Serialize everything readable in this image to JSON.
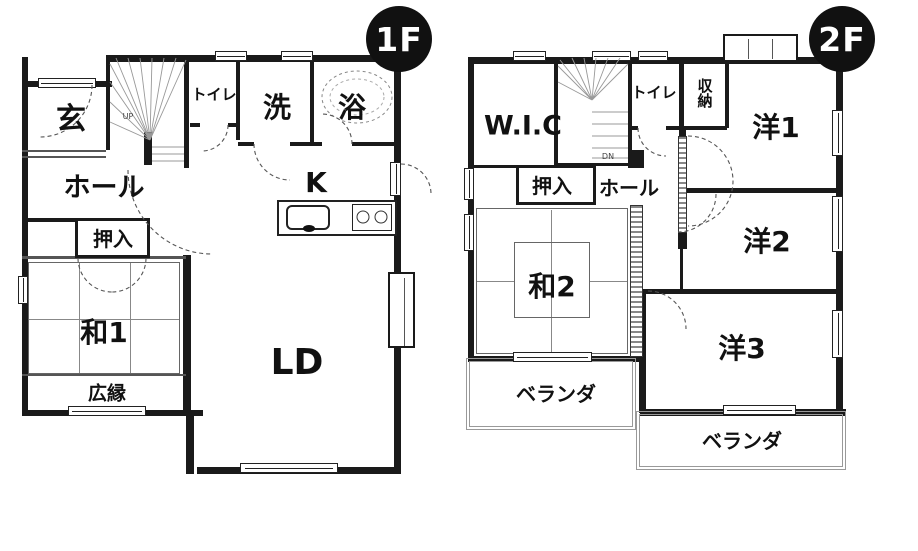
{
  "floor1": {
    "badge": "1F",
    "labels": {
      "genkan": "玄",
      "hall": "ホール",
      "oshiire": "押入",
      "toilet": "トイレ",
      "wash": "洗",
      "bath": "浴",
      "kitchen": "K",
      "wa1": "和1",
      "hiroen": "広縁",
      "ld": "LD",
      "up": "UP"
    }
  },
  "floor2": {
    "badge": "2F",
    "labels": {
      "wic": "W.I.C",
      "toilet": "トイレ",
      "shunou": "収納",
      "yo1": "洋1",
      "oshiire": "押入",
      "hall": "ホール",
      "wa2": "和2",
      "yo2": "洋2",
      "yo3": "洋3",
      "veranda_left": "ベランダ",
      "veranda_right": "ベランダ",
      "dn": "DN"
    }
  },
  "colors": {
    "wall": "#1a1a1a",
    "badge_bg": "#111111",
    "badge_text": "#ffffff"
  }
}
